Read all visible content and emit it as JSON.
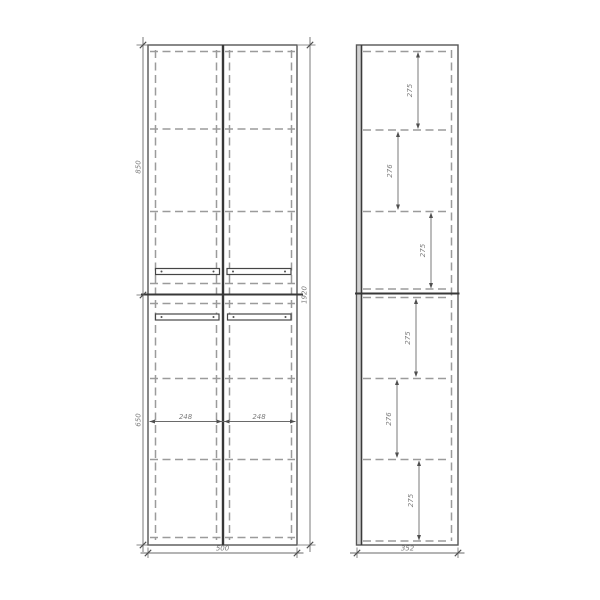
{
  "front_view": {
    "overall_width": "500",
    "overall_height": "1920",
    "upper_section_height": "850",
    "lower_section_height": "650",
    "left_door_width": "248",
    "right_door_width": "248"
  },
  "side_view": {
    "overall_depth": "352",
    "shelf_spacings": [
      "275",
      "276",
      "275",
      "275",
      "276",
      "275"
    ]
  },
  "colors": {
    "background": "#ffffff",
    "outline": "#565656",
    "hidden_line": "#9b9b9b",
    "dimension_text": "#7d7d7d"
  }
}
